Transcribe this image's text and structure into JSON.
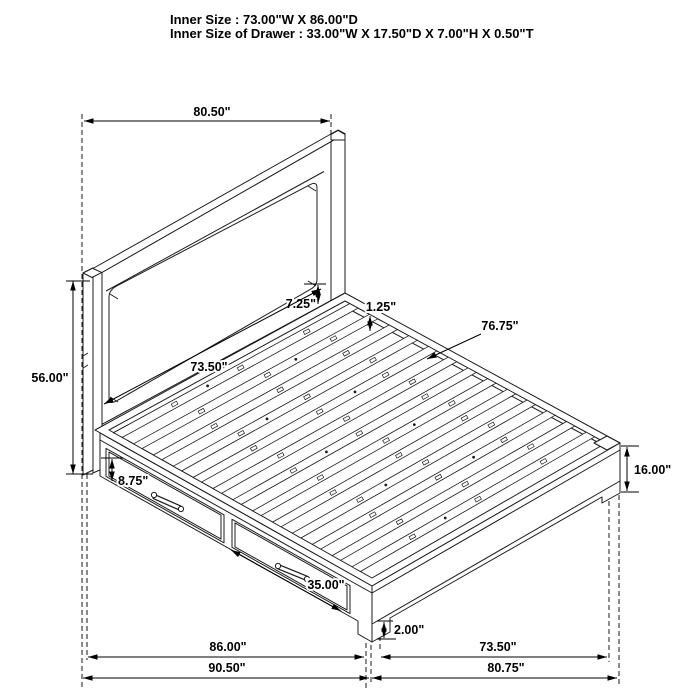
{
  "title": {
    "line1": "Inner Size : 73.00\"W X 86.00\"D",
    "line2": "Inner Size of Drawer : 33.00\"W X 17.50\"D X 7.00\"H X 0.50\"T"
  },
  "dimensions": {
    "headboard_width": "80.50\"",
    "headboard_height": "56.00\"",
    "panel_to_rail_gap": "7.25\"",
    "slat_recess": "1.25\"",
    "slat_length": "76.75\"",
    "panel_width": "73.50\"",
    "drawer_opening_height": "8.75\"",
    "drawer_front_width": "35.00\"",
    "platform_height": "16.00\"",
    "leg_clearance": "2.00\"",
    "side_rail_length": "86.00\"",
    "overall_depth": "90.50\"",
    "foot_rail_length": "73.50\"",
    "overall_width": "80.75\""
  }
}
